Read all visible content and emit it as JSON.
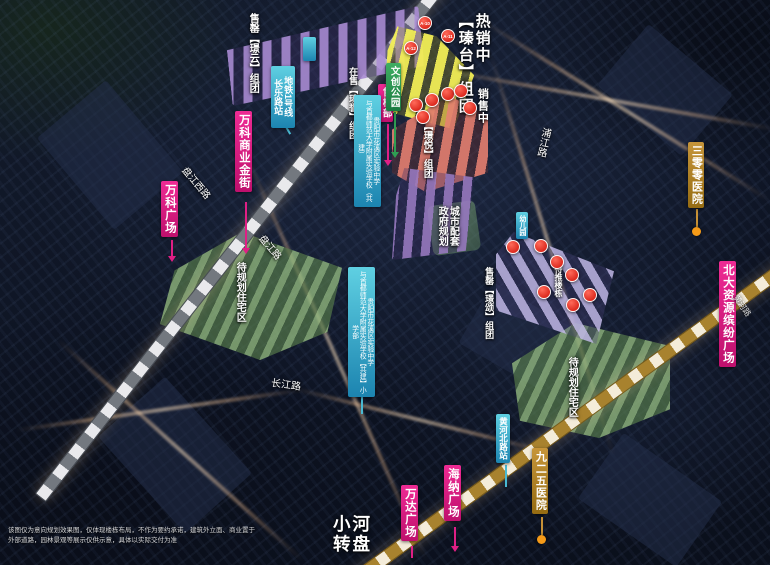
{
  "clusters": {
    "zhentai_status": "热销中",
    "zhentai_name": "【瑧台】组团",
    "selling": "销售中",
    "jingyun": "售罄【璟云】组团",
    "zhenyu": "在售【瑧誉】组团",
    "jingyue": "【璟悦】组团",
    "jingsong": "售罄【璟颂】组团",
    "pending_towers": "待推楼栋"
  },
  "markers": {
    "a10": "A-10",
    "a11": "A-11",
    "a12": "A-12"
  },
  "places": {
    "sales_office": "售楼部",
    "cultural_park": "文创公园",
    "wanke_golden_street": "万科商业金街",
    "wanke_plaza": "万科广场",
    "wanda_plaza": "万达广场",
    "haina_plaza": "海纳广场",
    "beida_plaza": "北大资源缤纷广场",
    "hospital_300": "三零零医院",
    "hospital_925": "九二五医院",
    "city_support_line1": "城市配套",
    "city_support_line2": "政府规划",
    "school_line1": "贵阳市花溪区实验中学",
    "school_line2": "与首都师范大学附属实验学校（共建）",
    "school_primary_line1": "贵阳市花溪区实验中学",
    "school_primary_line2": "与首都师范大学附属实验学校【共建】小学部",
    "kindergarten": "幼儿园",
    "planned_left": "待规划住宅区",
    "planned_right": "待规划住宅区",
    "xiaohe_line1": "小河",
    "xiaohe_line2": "转盘"
  },
  "transit": {
    "metro_line": "地铁1号线",
    "changle_station": "长乐路站",
    "huanghe_station": "黄河北路站"
  },
  "roads": {
    "panjiang_west": "盘江西路",
    "panjiang": "盘江路",
    "pujiang": "浦江路",
    "changjiang": "长江路",
    "huanghe": "黄河路"
  },
  "disclaimer": {
    "line1": "该图仅为意向规划效果图，仅体现楼栋布局，不作为要约承诺，建筑外立面、商业置于",
    "line2": "外部道路，园林景观等展示仅供示意，具体以实际交付为准"
  },
  "colors": {
    "label_magenta": "#d6197f",
    "label_gold": "#a87c20",
    "label_teal": "#2aa3c4",
    "label_green": "#2f9e53",
    "marker_red": "#d41408",
    "rail_metro": "#7a7f88",
    "rail_gold": "#b8872b",
    "highlight_yellow": "#f0ee55"
  }
}
